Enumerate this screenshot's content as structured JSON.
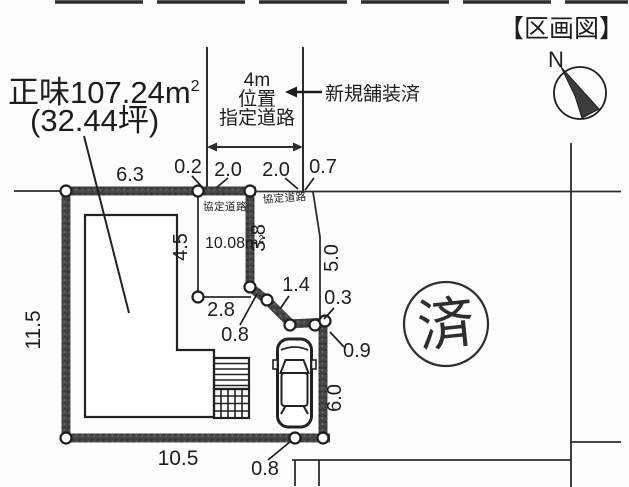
{
  "title": "【区画図】",
  "compass": {
    "north": "N"
  },
  "area_label": {
    "main": "正味107.24m",
    "sup": "2",
    "tsubo": "(32.44坪)"
  },
  "designated_road": {
    "line1": "4m",
    "line2": "位置",
    "line3": "指定道路",
    "paved_note": "新規舗装済"
  },
  "agreement_road": {
    "left_label": "協定道路",
    "right_label": "協定道路"
  },
  "sub_area": {
    "main": "10.08m",
    "sup": "2"
  },
  "stamp": "済",
  "dims": {
    "top_width": "6.3",
    "gap_left": "0.2",
    "kyotei_left_width": "2.0",
    "kyotei_right_width": "2.0",
    "gap_right": "0.7",
    "west_height": "11.5",
    "strip_height": "4.5",
    "strip_right_height": "3.8",
    "east_upper": "5.0",
    "notch_width": "2.8",
    "notch_diag_short": "0.8",
    "notch_diag_long": "1.4",
    "corner_gap": "0.3",
    "east_point_offset": "0.9",
    "east_lower": "6.0",
    "south_width": "10.5",
    "south_gap": "0.8"
  }
}
